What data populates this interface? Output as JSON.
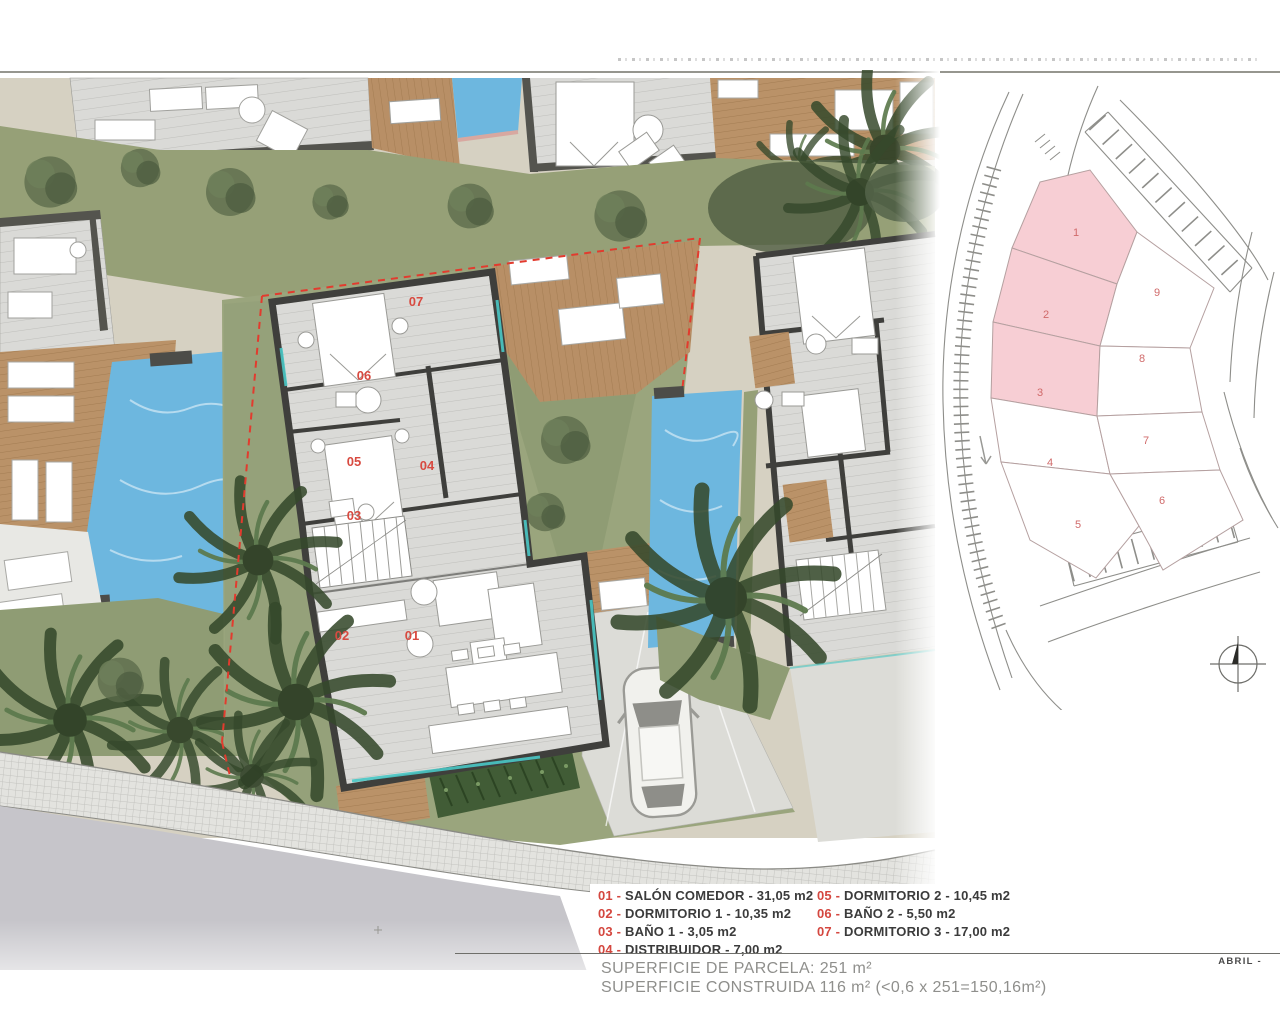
{
  "legend": {
    "sep": " - ",
    "items": [
      {
        "num": "01",
        "label": "SALÓN COMEDOR - 31,05 m2"
      },
      {
        "num": "02",
        "label": "DORMITORIO 1 - 10,35 m2"
      },
      {
        "num": "03",
        "label": "BAÑO 1 - 3,05 m2"
      },
      {
        "num": "04",
        "label": "DISTRIBUIDOR - 7,00 m2"
      },
      {
        "num": "05",
        "label": "DORMITORIO 2 - 10,45 m2"
      },
      {
        "num": "06",
        "label": "BAÑO 2 - 5,50 m2"
      },
      {
        "num": "07",
        "label": "DORMITORIO 3 - 17,00 m2"
      }
    ]
  },
  "surface": {
    "line1": "SUPERFICIE DE PARCELA: 251 m²",
    "line2": "SUPERFICIE CONSTRUIDA 116 m² (<0,6 x 251=150,16m²)"
  },
  "footer": {
    "month": "ABRIL -"
  },
  "floor_plan": {
    "room_labels": {
      "r01": "01",
      "r02": "02",
      "r03": "03",
      "r04": "04",
      "r05": "05",
      "r06": "06",
      "r07": "07"
    }
  },
  "site_map": {
    "plots": [
      {
        "label": "1",
        "highlighted": true
      },
      {
        "label": "2",
        "highlighted": true
      },
      {
        "label": "3",
        "highlighted": true
      },
      {
        "label": "4",
        "highlighted": false
      },
      {
        "label": "5",
        "highlighted": false
      },
      {
        "label": "6",
        "highlighted": false
      },
      {
        "label": "7",
        "highlighted": false
      },
      {
        "label": "8",
        "highlighted": false
      },
      {
        "label": "9",
        "highlighted": false
      }
    ]
  },
  "colors": {
    "accent_red": "#d84a40",
    "boundary_red": "#e23b2e",
    "plot_pink": "#f7ced4",
    "pool_blue": "#6db7df",
    "deck_tan": "#ba9268",
    "grass_green": "#96a077",
    "wall_dark": "#3f3f3c",
    "road_gray": "#c6c5ca"
  }
}
